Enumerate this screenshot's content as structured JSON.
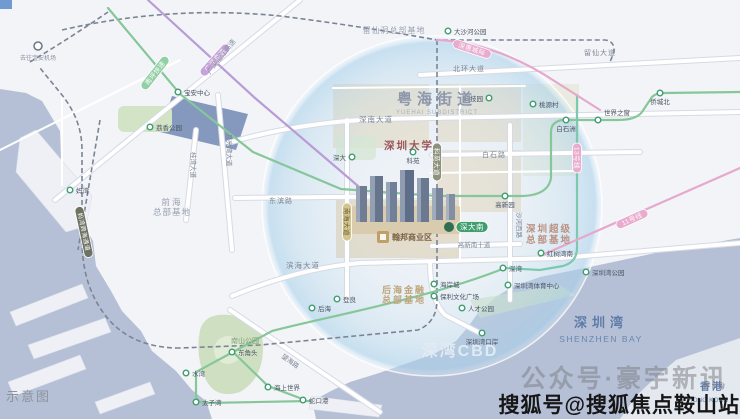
{
  "watermarks": {
    "schematic": "示意图",
    "wechat": "公众号·豪宇新讯",
    "sohu": "搜狐号@搜狐焦点鞍山站"
  },
  "colors": {
    "sea": "#b5c0d7",
    "land": "#f3f4f8",
    "station_ring": "#3f9e6e",
    "project_gold": "#bfa066",
    "circle_glow": "#aad2eb"
  },
  "map": {
    "project": {
      "label": "翰邦商业区"
    },
    "labels": [
      {
        "name": "yuehai-street",
        "t": "粤海街道",
        "x": 437,
        "y": 104,
        "size": 15,
        "color": "#8d96ab",
        "bold": 1,
        "ls": 5
      },
      {
        "name": "yuehai-street-en",
        "t": "YUEHAI SUBDISTRICT",
        "x": 437,
        "y": 114,
        "size": 6,
        "color": "#a6aebd",
        "ls": 1
      },
      {
        "name": "liuxiandong-hq",
        "t": "留仙洞总部基地",
        "x": 394,
        "y": 33,
        "size": 8,
        "color": "#99a2b0",
        "ls": 1
      },
      {
        "name": "shenzhen-university",
        "t": "深圳大学",
        "x": 409,
        "y": 149,
        "size": 10.5,
        "color": "#9a555c",
        "bold": 1,
        "ls": 2
      },
      {
        "name": "qianhai-hq-1",
        "t": "前海",
        "x": 172,
        "y": 205,
        "size": 8.5,
        "color": "#98a2ae",
        "ls": 2
      },
      {
        "name": "qianhai-hq-2",
        "t": "总部基地",
        "x": 172,
        "y": 215,
        "size": 8.5,
        "color": "#98a2ae",
        "ls": 1
      },
      {
        "name": "super-hq-1",
        "t": "深圳超级",
        "x": 549,
        "y": 232,
        "size": 9.5,
        "color": "#bb9184",
        "bold": 1,
        "ls": 2
      },
      {
        "name": "super-hq-2",
        "t": "总部基地",
        "x": 549,
        "y": 243,
        "size": 9.5,
        "color": "#bb9184",
        "bold": 1,
        "ls": 2
      },
      {
        "name": "houhai-hq-1",
        "t": "后海金融",
        "x": 404,
        "y": 293,
        "size": 9,
        "color": "#bfa57d",
        "bold": 1,
        "ls": 2
      },
      {
        "name": "houhai-hq-2",
        "t": "总部基地",
        "x": 404,
        "y": 303,
        "size": 9,
        "color": "#bfa57d",
        "bold": 1,
        "ls": 2
      },
      {
        "name": "shenwan-cbd",
        "t": "深湾CBD",
        "x": 460,
        "y": 356,
        "size": 16,
        "color": "#e3ecf4",
        "bold": 1,
        "ls": 2,
        "op": 0.95
      },
      {
        "name": "shenzhen-bay",
        "t": "深圳湾",
        "x": 601,
        "y": 327,
        "size": 13,
        "color": "#5f7ca8",
        "bold": 1,
        "ls": 5
      },
      {
        "name": "shenzhen-bay-en",
        "t": "SHENZHEN BAY",
        "x": 601,
        "y": 342,
        "size": 8.5,
        "color": "#6a86ab",
        "ls": 1.5
      },
      {
        "name": "hongkong",
        "t": "香港",
        "x": 712,
        "y": 390,
        "size": 10,
        "color": "#5f7ca8",
        "bold": 1,
        "ls": 2
      },
      {
        "name": "hongkong-en",
        "t": "HONG KONG",
        "x": 708,
        "y": 402,
        "size": 6.5,
        "color": "#6a86ab"
      },
      {
        "name": "nanshan-park-label",
        "t": "南山公园",
        "x": 245,
        "y": 343,
        "size": 7,
        "color": "#7c9a70"
      },
      {
        "name": "airport-note",
        "t": "去往宝安机场",
        "x": 38,
        "y": 60,
        "size": 6,
        "color": "#8a94a2"
      },
      {
        "name": "road-shennan",
        "t": "深南大道",
        "x": 376,
        "y": 122,
        "size": 7.5,
        "color": "#7d8694",
        "ls": 1
      },
      {
        "name": "road-beihuan",
        "t": "北环大道",
        "x": 469,
        "y": 71,
        "size": 7,
        "color": "#7d8694",
        "ls": 1
      },
      {
        "name": "road-liuxian",
        "t": "留仙大道",
        "x": 600,
        "y": 55,
        "size": 7,
        "color": "#7d8694",
        "ls": 1
      },
      {
        "name": "road-baishi",
        "t": "白石路",
        "x": 494,
        "y": 157,
        "size": 7,
        "color": "#7d8694",
        "ls": 1
      },
      {
        "name": "road-gaoxin-s10",
        "t": "高新南十道",
        "x": 474,
        "y": 247,
        "size": 6.5,
        "color": "#7d8694"
      },
      {
        "name": "road-binhai",
        "t": "滨海大道",
        "x": 303,
        "y": 268,
        "size": 7.5,
        "color": "#7d8694",
        "ls": 1
      },
      {
        "name": "road-dongbin",
        "t": "东滨路",
        "x": 281,
        "y": 203,
        "size": 7,
        "color": "#7d8694",
        "ls": 1
      },
      {
        "name": "road-shahexi",
        "t": "沙河西路",
        "x": 517,
        "y": 225,
        "size": 6.5,
        "color": "#7d8694",
        "rot": 90
      },
      {
        "name": "road-yueliangwan",
        "t": "月亮湾大道",
        "x": 227,
        "y": 150,
        "size": 6.5,
        "color": "#7d8694",
        "rot": 90
      },
      {
        "name": "road-guiwan",
        "t": "桂湾大道",
        "x": 191,
        "y": 165,
        "size": 6.5,
        "color": "#7d8694",
        "rot": 90
      },
      {
        "name": "road-yanjiang-expwy",
        "t": "广深沿江高速",
        "x": 223,
        "y": 58,
        "size": 7,
        "color": "#8a93a1",
        "rot": -52
      },
      {
        "name": "road-wanghai",
        "t": "望海路",
        "x": 289,
        "y": 363,
        "size": 6.5,
        "color": "#7d8694",
        "rot": 35
      }
    ],
    "stations": [
      {
        "t": "大沙河公园",
        "x": 448,
        "y": 31,
        "lx": 454,
        "ly": 34,
        "anchor": "start"
      },
      {
        "t": "宝安中心",
        "x": 178,
        "y": 92,
        "lx": 184,
        "ly": 95,
        "anchor": "start"
      },
      {
        "t": "妈湾",
        "x": 70,
        "y": 190,
        "lx": 76,
        "ly": 193,
        "anchor": "start"
      },
      {
        "t": "荔香公园",
        "x": 150,
        "y": 127,
        "lx": 156,
        "ly": 130,
        "anchor": "start"
      },
      {
        "t": "科技园",
        "x": 489,
        "y": 98,
        "lx": 483,
        "ly": 101,
        "anchor": "end"
      },
      {
        "t": "桃源村",
        "x": 533,
        "y": 104,
        "lx": 539,
        "ly": 107,
        "anchor": "start"
      },
      {
        "t": "白石洲",
        "x": 566,
        "y": 120,
        "lx": 566,
        "ly": 131,
        "anchor": "middle"
      },
      {
        "t": "世界之窗",
        "x": 598,
        "y": 120,
        "lx": 604,
        "ly": 115,
        "anchor": "start"
      },
      {
        "t": "侨城北",
        "x": 660,
        "y": 93,
        "lx": 660,
        "ly": 104,
        "anchor": "middle"
      },
      {
        "t": "深大",
        "x": 352,
        "y": 157,
        "lx": 346,
        "ly": 160,
        "anchor": "end"
      },
      {
        "t": "科苑",
        "x": 413,
        "y": 152,
        "lx": 413,
        "ly": 163,
        "anchor": "middle"
      },
      {
        "t": "高新园",
        "x": 505,
        "y": 196,
        "lx": 505,
        "ly": 207,
        "anchor": "middle"
      },
      {
        "t": "红树湾南",
        "x": 541,
        "y": 253,
        "lx": 547,
        "ly": 256,
        "anchor": "start"
      },
      {
        "t": "深湾",
        "x": 503,
        "y": 268,
        "lx": 509,
        "ly": 271,
        "anchor": "start"
      },
      {
        "t": "深圳湾公园",
        "x": 586,
        "y": 272,
        "lx": 592,
        "ly": 275,
        "anchor": "start"
      },
      {
        "t": "深圳湾体育中心",
        "x": 508,
        "y": 285,
        "lx": 514,
        "ly": 288,
        "anchor": "start"
      },
      {
        "t": "海岸城",
        "x": 434,
        "y": 284,
        "lx": 440,
        "ly": 287,
        "anchor": "start"
      },
      {
        "t": "保利文化广场",
        "x": 434,
        "y": 296,
        "lx": 440,
        "ly": 299,
        "anchor": "start"
      },
      {
        "t": "人才公园",
        "x": 462,
        "y": 308,
        "lx": 468,
        "ly": 311,
        "anchor": "start"
      },
      {
        "t": "深圳湾口岸",
        "x": 482,
        "y": 333,
        "lx": 482,
        "ly": 344,
        "anchor": "middle"
      },
      {
        "t": "登良",
        "x": 337,
        "y": 299,
        "lx": 343,
        "ly": 302,
        "anchor": "start"
      },
      {
        "t": "后海",
        "x": 312,
        "y": 308,
        "lx": 318,
        "ly": 311,
        "anchor": "start"
      },
      {
        "t": "东角头",
        "x": 232,
        "y": 352,
        "lx": 238,
        "ly": 355,
        "anchor": "start"
      },
      {
        "t": "水湾",
        "x": 186,
        "y": 373,
        "lx": 192,
        "ly": 376,
        "anchor": "start"
      },
      {
        "t": "海上世界",
        "x": 268,
        "y": 387,
        "lx": 274,
        "ly": 390,
        "anchor": "start"
      },
      {
        "t": "蛇口港",
        "x": 303,
        "y": 400,
        "lx": 309,
        "ly": 403,
        "anchor": "start"
      },
      {
        "t": "太子湾",
        "x": 196,
        "y": 402,
        "lx": 202,
        "ly": 405,
        "anchor": "start"
      }
    ],
    "capsules": [
      {
        "t": "南坪快速",
        "x": 155,
        "y": 73,
        "angle": -52,
        "fill": "#93cfa4",
        "color": "#ffffff",
        "w": 40,
        "h": 9,
        "size": 6.5
      },
      {
        "t": "广深高速",
        "x": 215,
        "y": 60,
        "angle": -48,
        "fill": "#c6a3da",
        "color": "#ffffff",
        "w": 40,
        "h": 9,
        "size": 6.5
      },
      {
        "t": "深惠城际",
        "x": 472,
        "y": 49,
        "angle": 18,
        "fill": "#e9abce",
        "color": "#ffffff",
        "w": 40,
        "h": 9,
        "size": 6.5
      },
      {
        "t": "11号线",
        "x": 632,
        "y": 219,
        "angle": -24,
        "fill": "#e9abce",
        "color": "#ffffff",
        "w": 34,
        "h": 9,
        "size": 6.5
      },
      {
        "t": "13号线",
        "x": 577,
        "y": 158,
        "angle": 90,
        "fill": "#e9abce",
        "color": "#ffffff",
        "w": 30,
        "h": 9,
        "size": 6.5
      },
      {
        "t": "科苑大道",
        "x": 437,
        "y": 162,
        "angle": 90,
        "fill": "#8d927e",
        "color": "#ffffff",
        "w": 38,
        "h": 9,
        "size": 6.5
      },
      {
        "t": "南海大道",
        "x": 347,
        "y": 222,
        "angle": 90,
        "fill": "#d3c48e",
        "color": "#6b5f34",
        "w": 38,
        "h": 9,
        "size": 6.5
      },
      {
        "t": "妈湾跨海通道",
        "x": 84,
        "y": 232,
        "angle": 78,
        "fill": "#6e7263",
        "color": "#ffffff",
        "w": 52,
        "h": 9,
        "size": 6
      },
      {
        "t": "深大南",
        "x": 472,
        "y": 227,
        "angle": 0,
        "fill": "#3f9e6e",
        "color": "#ffffff",
        "w": 32,
        "h": 11,
        "size": 7.5
      }
    ]
  }
}
